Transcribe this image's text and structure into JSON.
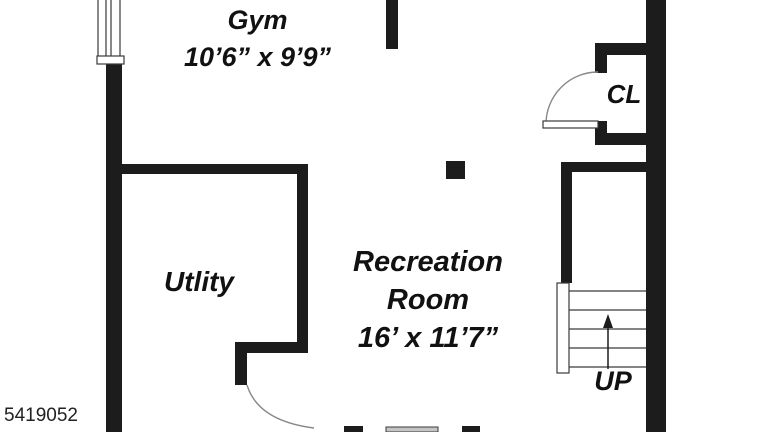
{
  "title": "Basement floor plan",
  "listing_id": "5419052",
  "colors": {
    "wall": "#1c1c1c",
    "background": "#ffffff",
    "line": "#3a3a3a",
    "arc": "#888888",
    "glass": "#c4c4c4",
    "text": "#111111"
  },
  "rooms": {
    "gym": {
      "name": "Gym",
      "dimensions": "10’6” x 9’9”"
    },
    "recreation": {
      "name_line1": "Recreation",
      "name_line2": "Room",
      "dimensions": "16’ x 11’7”"
    },
    "utility": {
      "name": "Utlity"
    },
    "closet": {
      "name": "CL"
    }
  },
  "stairs": {
    "label": "UP",
    "direction": "up"
  },
  "features": {
    "window_top_left": "window-symbol",
    "column": "support-column",
    "closet_door": "door-swing-left",
    "utility_door": "door-swing-down",
    "bottom_window": "window-segment"
  }
}
